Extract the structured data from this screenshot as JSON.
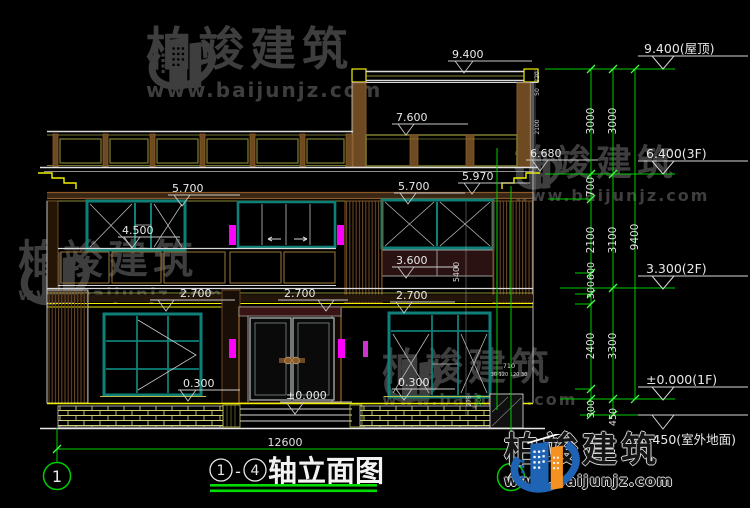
{
  "brand": {
    "name_cn": "柏竣建筑",
    "url": "www.baijunjz.com"
  },
  "title": {
    "bubble_left": "1",
    "bubble_right": "4",
    "separator": "-",
    "text": "轴立面图",
    "total_width": "12600"
  },
  "axis_bubbles": {
    "left": "1",
    "right": "4"
  },
  "elevation_marks": {
    "m1": "9.400",
    "m2": "7.600",
    "m3": "6.680",
    "m4": "5.970",
    "m5": "5.700",
    "m6": "5.700",
    "m7": "4.500",
    "m8": "3.600",
    "m9": "2.700",
    "m10": "2.700",
    "m11": "2.700",
    "m12": "0.300",
    "m13": "±0.000",
    "m14": "0.300"
  },
  "story_marks": {
    "roof": "9.400(屋顶)",
    "f3": "6.400(3F)",
    "f2": "3.300(2F)",
    "f1": "±0.000(1F)",
    "ground": "-0.450(室外地面)"
  },
  "dims": {
    "colA": {
      "d1": "3000",
      "d2": "700",
      "d3": "2100",
      "d4": "600",
      "d5": "300",
      "d6": "2400",
      "d7": "300"
    },
    "colB": {
      "d1": "3000",
      "d2": "3100",
      "d3": "3300",
      "d4": "450"
    },
    "colC": {
      "d1": "9400"
    },
    "micro": {
      "d5400": "5400",
      "d220": "220",
      "d50": "50",
      "d2100": "2100",
      "d710": "710",
      "dcluster": "30 120 120 30",
      "d275": "275",
      "d300": "300"
    }
  },
  "colors": {
    "accent_green": "#00cc00",
    "line_white": "#d9d9d9",
    "brown": "#8a5a2a",
    "teal": "#0e8077",
    "yellow": "#efef00",
    "magenta": "#ff00ff"
  }
}
